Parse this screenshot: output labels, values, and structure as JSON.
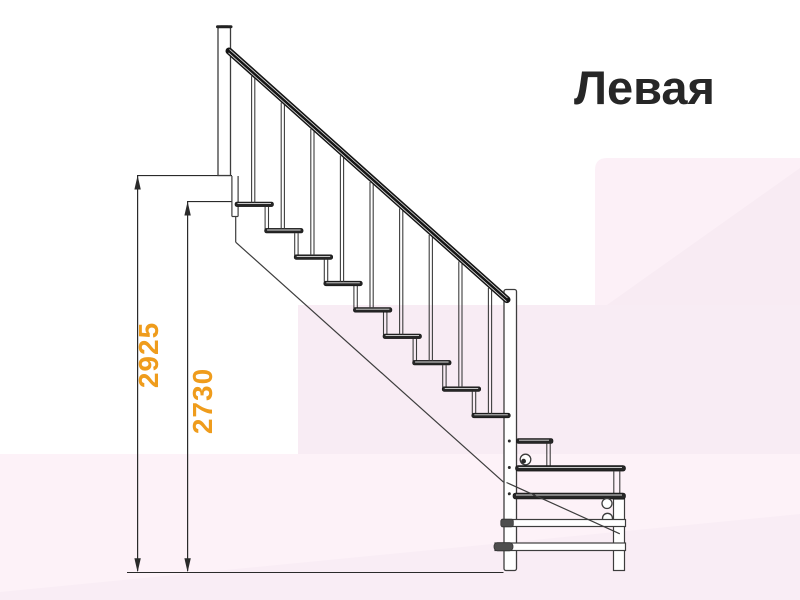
{
  "title": {
    "text": "Левая"
  },
  "dimensions": {
    "total_height": "2925",
    "to_first_tread": "2730"
  },
  "colors": {
    "dimension_text": "#ef9c1c",
    "title_text": "#262626",
    "drawing_lines": "#3d3d3d",
    "tread_fill": "#262626",
    "background_tints": [
      "#fcf0f7",
      "#f8ebf3",
      "#f8ecf4",
      "#fdf2f8",
      "#f9edf5"
    ]
  },
  "staircase": {
    "type": "staircase-side-view-technical-drawing",
    "main_flight_tread_count": 9,
    "baluster_count": 9,
    "landing_step_count": 3
  }
}
